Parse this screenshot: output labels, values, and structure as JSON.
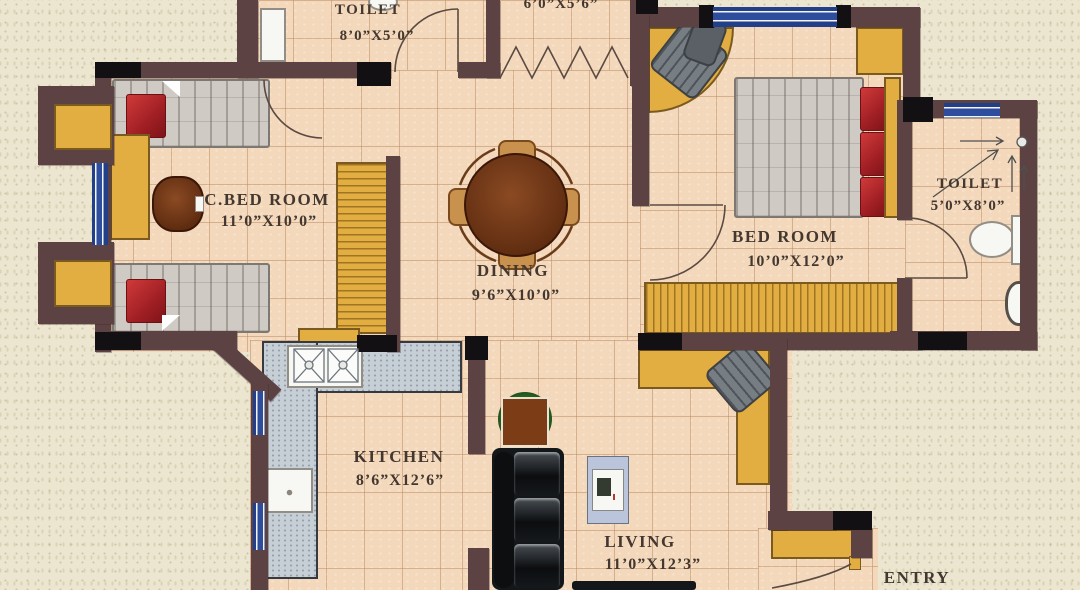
{
  "plan": {
    "type": "apartment-floor-plan",
    "rooms": {
      "toilet_top": {
        "name": "TOILET",
        "dims": "8’0”X5’0”"
      },
      "utility": {
        "name": "",
        "dims": "6’0”X5’6”"
      },
      "cbedroom": {
        "name": "C.BED ROOM",
        "dims": "11’0”X10’0”"
      },
      "dining": {
        "name": "DINING",
        "dims": "9’6”X10’0”"
      },
      "bedroom": {
        "name": "BED ROOM",
        "dims": "10’0”X12’0”"
      },
      "toilet_right": {
        "name": "TOILET",
        "dims": "5’0”X8’0”"
      },
      "kitchen": {
        "name": "KITCHEN",
        "dims": "8’6”X12’6”"
      },
      "living": {
        "name": "LIVING",
        "dims": "11’0”X12’3”"
      },
      "entry": {
        "name": "ENTRY",
        "dims": ""
      }
    },
    "colors": {
      "wall": "#5d4243",
      "column": "#121013",
      "floor_tile": "#f3d8bb",
      "outside": "#ece6d1",
      "window_blue": "#2e4d9c",
      "wood_yellow": "#e2ad41",
      "kitchen_counter": "#c6ced6",
      "sofa_black": "#14171a",
      "pillow_red": "#b4282d",
      "table_wood": "#74391b",
      "label_text": "#43372f"
    }
  }
}
